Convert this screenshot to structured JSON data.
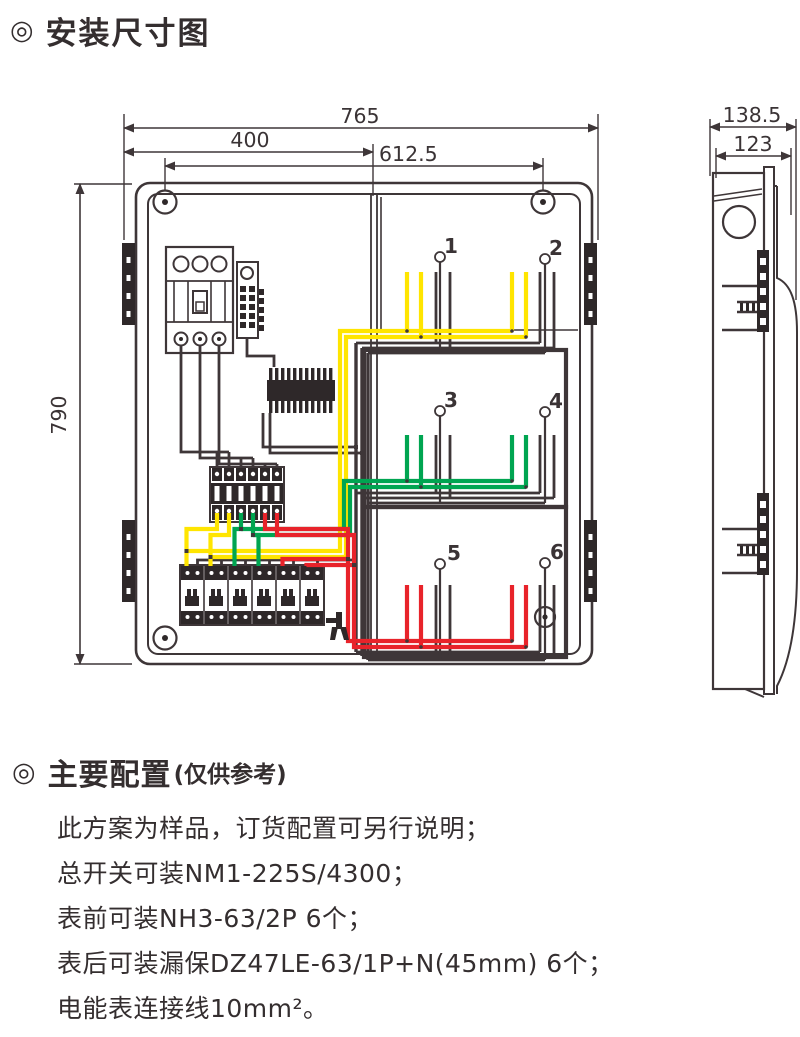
{
  "header": {
    "bullet": "◎",
    "title": "安装尺寸图"
  },
  "drawing": {
    "front_view": {
      "dim_overall_width": "765",
      "dim_left_width": "400",
      "dim_hole_span": "612.5",
      "dim_height": "790",
      "meter_positions": [
        "1",
        "2",
        "3",
        "4",
        "5",
        "6"
      ]
    },
    "side_view": {
      "dim_depth": "138.5",
      "dim_door_depth": "123"
    },
    "wire_colors": {
      "phase_yellow": "#ffe500",
      "phase_green": "#00a551",
      "phase_red": "#e8232a",
      "line": "#3e3638"
    }
  },
  "config": {
    "bullet": "◎",
    "title": "主要配置",
    "note": "(仅供参考)",
    "lines": [
      "此方案为样品，订货配置可另行说明；",
      "总开关可装NM1-225S/4300；",
      "表前可装NH3-63/2P  6个；",
      "表后可装漏保DZ47LE-63/1P+N(45mm) 6个；",
      "电能表连接线10mm²。"
    ]
  }
}
